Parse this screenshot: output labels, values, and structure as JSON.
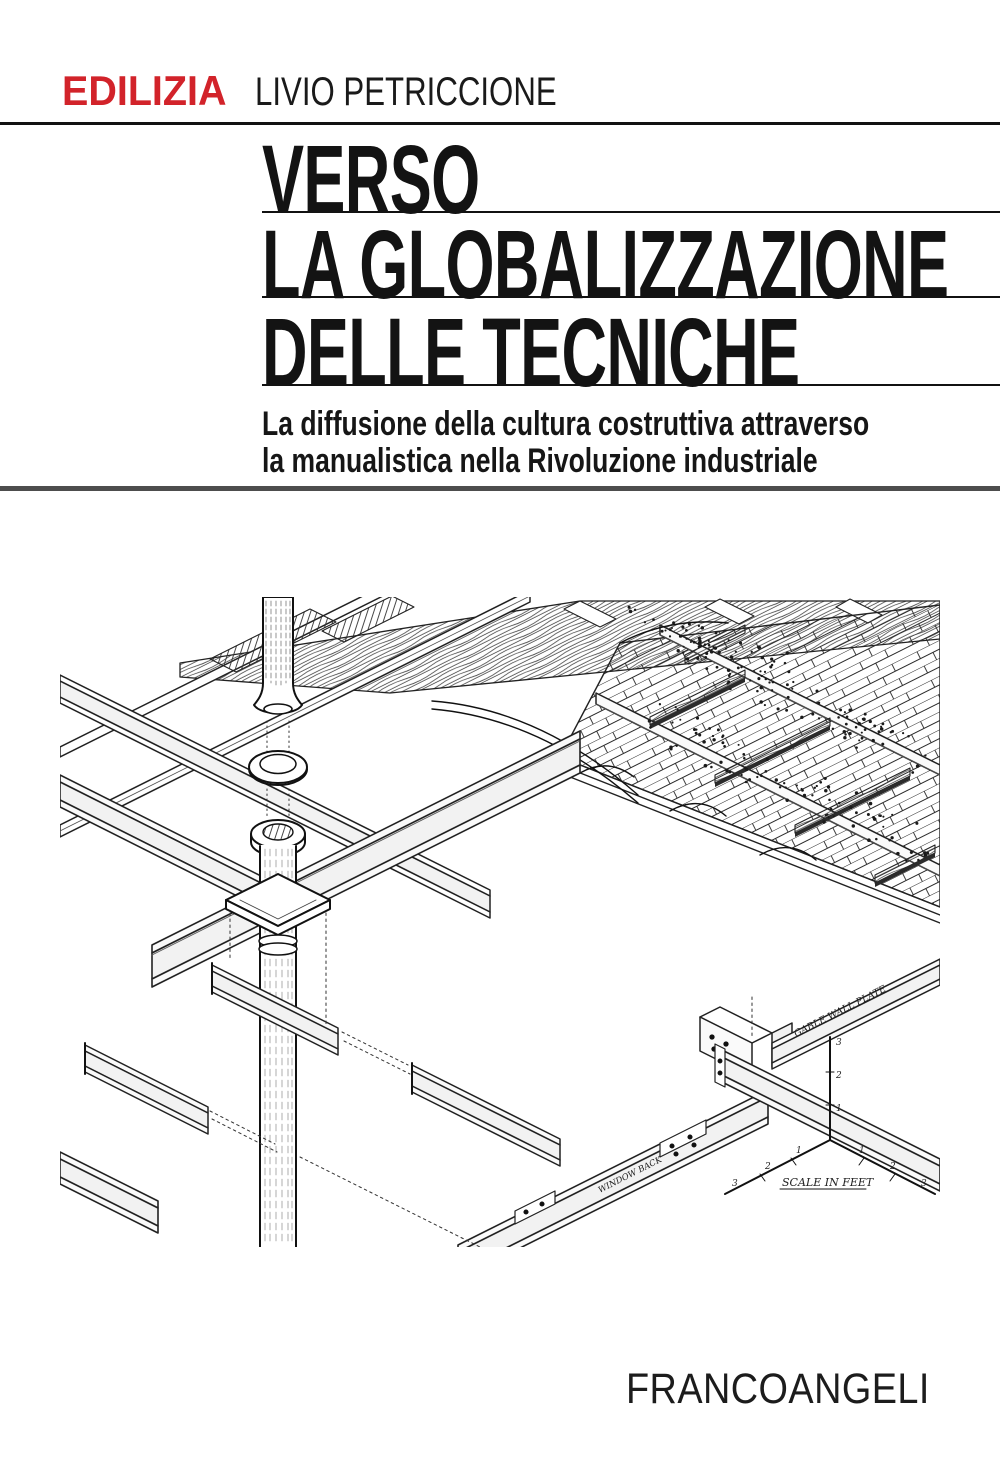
{
  "header": {
    "series_label": "EDILIZIA",
    "series_color": "#d2232a",
    "author": "LIVIO PETRICCIONE"
  },
  "title": {
    "line1": "VERSO",
    "line2": "LA GLOBALIZZAZIONE",
    "line3": "DELLE TECNICHE"
  },
  "subtitle": {
    "line1": "La diffusione della cultura costruttiva attraverso",
    "line2": "la manualistica nella Rivoluzione industriale"
  },
  "publisher": {
    "name": "FRANCOANGELI"
  },
  "illustration": {
    "description": "Isometric cutaway drawing of cast-iron column, wrought-iron beams and brick jack-arch fireproof floor construction",
    "labels": {
      "gable_wall_plate": "GABLE WALL PLATE",
      "window_back": "WINDOW BACK",
      "scale": "SCALE IN FEET"
    },
    "scale_ticks": [
      "1",
      "2",
      "3"
    ]
  },
  "colors": {
    "ink": "#111111",
    "rule_gray": "#4d4d4d",
    "paper": "#ffffff"
  }
}
